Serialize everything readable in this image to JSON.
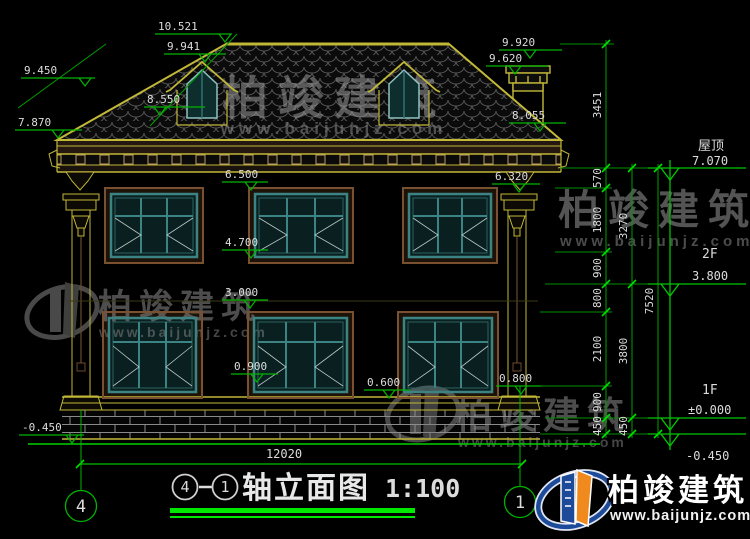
{
  "drawing_type": "architectural-elevation-cad",
  "colors": {
    "background": "#000000",
    "dim_green": "#00b400",
    "bright_green": "#00ee00",
    "outline_yellow": "#c2b838",
    "window_teal": "#3c8484",
    "frame_brown": "#7a5130",
    "cad_text": "#dcdcdc",
    "watermark_gray": "#999999",
    "logo_blue": "#1e4a9a",
    "logo_orange": "#f08a1e"
  },
  "levels": {
    "v10521": "10.521",
    "v9941": "9.941",
    "v9450": "9.450",
    "v8550": "8.550",
    "v7870": "7.870",
    "v9920": "9.920",
    "v9620": "9.620",
    "v8055": "8.055",
    "v6500": "6.500",
    "v4700": "4.700",
    "v6320": "6.320",
    "v3000": "3.000",
    "v0900": "0.900",
    "v0600": "0.600",
    "v0800": "0.800",
    "vm0450": "-0.450"
  },
  "floors": {
    "roof_name": "屋顶",
    "roof_elev": "7.070",
    "f2_name": "2F",
    "f2_elev": "3.800",
    "f1_name": "1F",
    "f1_elev": "±0.000",
    "below_elev": "-0.450"
  },
  "dims": {
    "d570": "570",
    "d1800": "1800",
    "d900a": "900",
    "d800": "800",
    "d2100": "2100",
    "d900b": "900",
    "d450a": "450",
    "d3270": "3270",
    "d3800": "3800",
    "d450b": "450",
    "d3451": "3451",
    "d7520": "7520",
    "d12020": "12020"
  },
  "axes": {
    "left": "4",
    "right": "1"
  },
  "title_block": {
    "circle_left": "4",
    "circle_right": "1",
    "name": "轴立面图",
    "scale": "1:100"
  },
  "watermark": {
    "brand": "柏竣建筑",
    "url": "www.baijunjz.com"
  }
}
